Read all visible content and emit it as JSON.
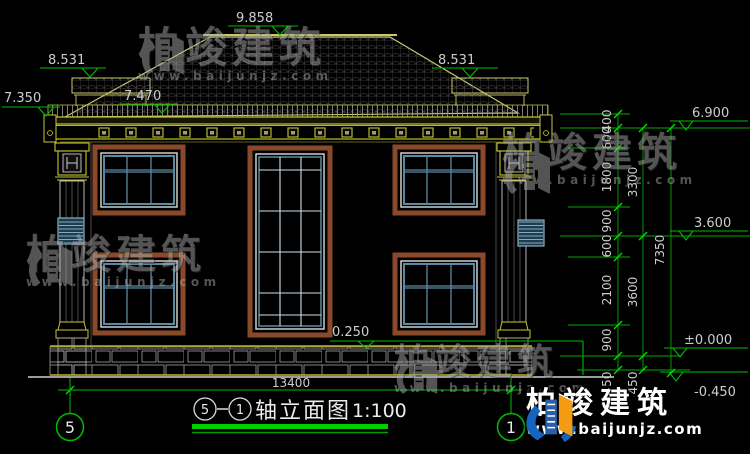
{
  "watermark": {
    "brand": "柏竣建筑",
    "site": "www.baijunjz.com"
  },
  "levels": {
    "ridge": "9.858",
    "wing_left": "8.531",
    "wing_right": "8.531",
    "eave_left": "7.350",
    "eave_inner": "7.470",
    "right_upper": "6.900",
    "right_mid": "3.600",
    "plinth": "0.250",
    "zero": "±0.000",
    "ground": "-0.450"
  },
  "dims": {
    "right_chain": [
      "400",
      "600",
      "1800",
      "900",
      "600",
      "2100",
      "900",
      "450"
    ],
    "right_chain2": [
      "3300",
      "3600",
      "450"
    ],
    "right_total": "7350",
    "bottom_total": "13400"
  },
  "axes": {
    "left": "5",
    "right": "1"
  },
  "title": {
    "axis_start": "5",
    "axis_end": "1",
    "name": "轴立面图",
    "scale": "1:100"
  }
}
